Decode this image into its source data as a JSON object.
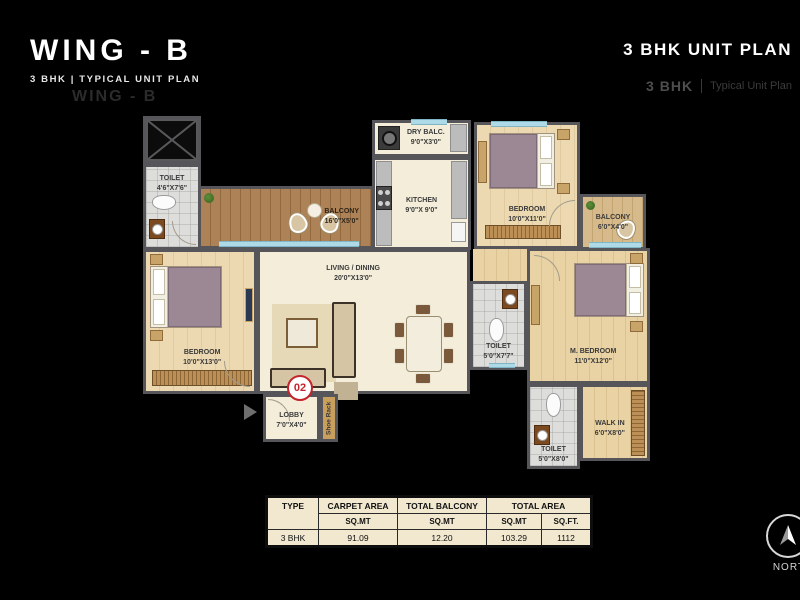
{
  "header": {
    "title": "WING - B",
    "subtitle": "3 BHK | TYPICAL UNIT PLAN",
    "ghost": "WING - B"
  },
  "header_right": {
    "title": "3 BHK UNIT PLAN",
    "ghost_bhk": "3 BHK",
    "ghost_divider": "|",
    "ghost_type": "Typical Unit Plan"
  },
  "plan": {
    "unit_marker": "02",
    "toilet_tl": {
      "name": "TOILET",
      "dims": "4'6\"X7'6\""
    },
    "balcony_main": {
      "name": "BALCONY",
      "dims": "16'0\"X5'0\""
    },
    "dry_balc": {
      "name": "DRY BALC.",
      "dims": "9'0\"X3'0\""
    },
    "kitchen": {
      "name": "KITCHEN",
      "dims": "9'0\"X 9'0\""
    },
    "bedroom_top": {
      "name": "BEDROOM",
      "dims": "10'0\"X11'0\""
    },
    "balcony_right": {
      "name": "BALCONY",
      "dims": "6'0\"X4'0\""
    },
    "living": {
      "name": "LIVING / DINING",
      "dims": "20'0\"X13'0\""
    },
    "bedroom_left": {
      "name": "BEDROOM",
      "dims": "10'0\"X13'0\""
    },
    "toilet_mid": {
      "name": "TOILET",
      "dims": "5'0\"X7'7\""
    },
    "m_bedroom": {
      "name": "M. BEDROOM",
      "dims": "11'0\"X12'0\""
    },
    "lobby": {
      "name": "LOBBY",
      "dims": "7'0\"X4'0\""
    },
    "shoe_rack": {
      "name": "Shoe Rack"
    },
    "walk_in": {
      "name": "WALK IN",
      "dims": "6'0\"X8'0\""
    },
    "toilet_bottom": {
      "name": "TOILET",
      "dims": "5'0\"X8'0\""
    }
  },
  "area_table": {
    "headers": [
      "TYPE",
      "CARPET AREA",
      "TOTAL BALCONY",
      "TOTAL AREA"
    ],
    "subheaders": [
      "SQ.MT",
      "SQ.MT",
      "SQ.MT",
      "SQ.FT."
    ],
    "row": [
      "3 BHK",
      "91.09",
      "12.20",
      "103.29",
      "1112"
    ]
  },
  "compass": {
    "label": "NORTH"
  },
  "colors": {
    "background": "#000000",
    "wall": "#56565a",
    "accent_red": "#c4242b",
    "table_bg": "#f2e8d0",
    "window_blue": "#aed9e6"
  }
}
